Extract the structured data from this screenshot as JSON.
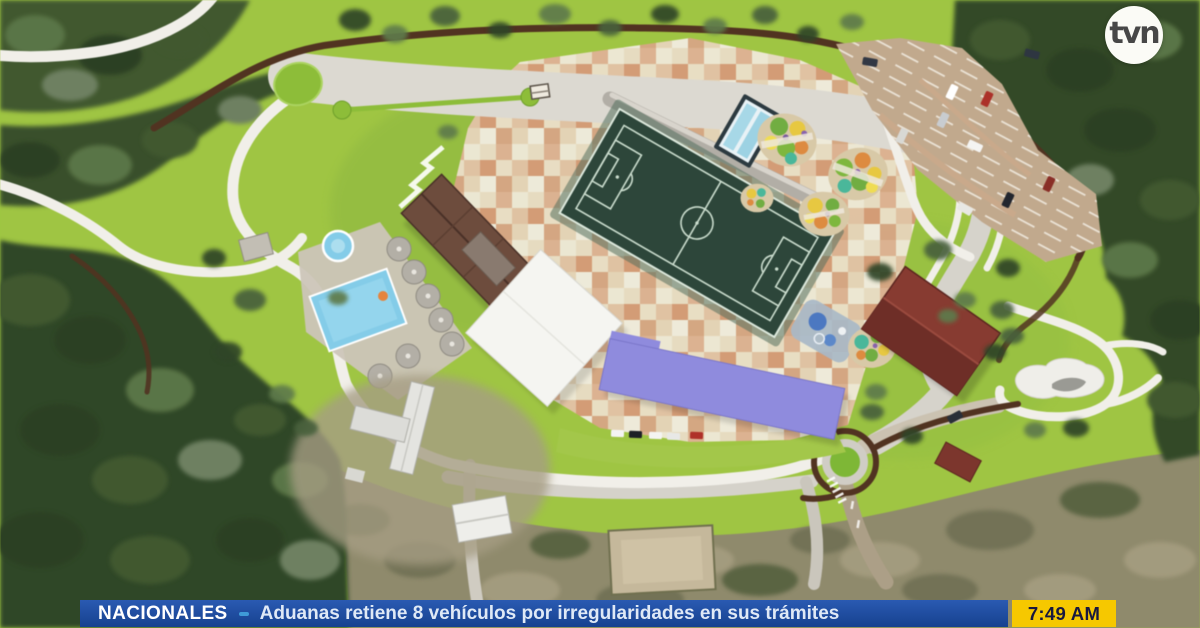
{
  "broadcast": {
    "channel": "tvn",
    "time": "7:49 AM"
  },
  "ticker": {
    "category": "NACIONALES",
    "headline": "Aduanas retiene 8 vehículos por irregularidades en sus trámites"
  },
  "palette": {
    "ticker_blue": "#1d4f9e",
    "ticker_headline_text": "#dfe9f6",
    "time_yellow": "#f6c800",
    "time_text": "#18183f",
    "grass_green": "#9ec63e",
    "forest_green": "#33492a",
    "soccer_field_green": "#2c463a",
    "plaza_tan": "#e7d8c2",
    "plaza_terracotta": "#d89a77",
    "pool_blue": "#82cdea",
    "building_purple": "#8f8be0",
    "building_red": "#8a3a30",
    "roof_brown": "#6e4c3c",
    "canopy_white": "#f5f5f1",
    "road_gray": "#d5d2ca",
    "trail_brown": "#523320",
    "parking_tan": "#c2a98c"
  },
  "map": {
    "type": "aerial-masterplan-rendering",
    "features": [
      "soccer-field",
      "swimming-pool",
      "kiddie-pool",
      "pool-umbrellas",
      "dressing-rooms-building",
      "white-canopy-building",
      "purple-building",
      "red-gym-building",
      "parking-lot",
      "playground-clusters",
      "splash-pad",
      "lap-lanes",
      "checker-plaza",
      "boulevard-with-median",
      "roundabout",
      "walking-trail",
      "skate-area",
      "forest",
      "scrubland",
      "dirt-field",
      "service-buildings",
      "roads",
      "parked-cars"
    ]
  }
}
